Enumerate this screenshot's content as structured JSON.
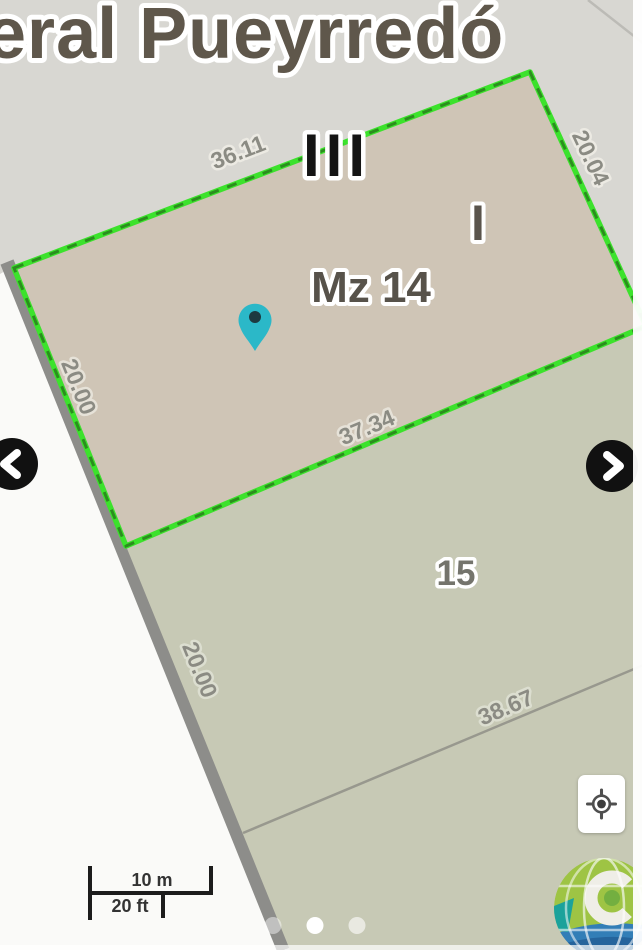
{
  "street": {
    "name": "eral Pueyrredó"
  },
  "parcel": {
    "block_label": "Mz 14",
    "edge_top": "36.11",
    "edge_right": "20.04",
    "edge_left": "20.00",
    "edge_bottom": "37.34"
  },
  "zones": {
    "roman_three": "III",
    "roman_one": "I"
  },
  "neighbor": {
    "number": "15",
    "edge_road": "20.00",
    "edge_lower": "38.67"
  },
  "scale_bar": {
    "metric": "10 m",
    "imperial": "20 ft"
  },
  "carousel": {
    "dot_count": 3,
    "active_dot": 2
  },
  "icons": {
    "prev": "chevron-left",
    "next": "chevron-right",
    "locate": "my-location-target",
    "marker": "map-pin",
    "watermark": "globe-logo"
  },
  "colors": {
    "boundary_green": "#3ce22c",
    "boundary_dash": "#2b8e1e",
    "parcel_fill": "#cfc5b6",
    "neighbor_fill": "#c7c9b5",
    "pavement": "#d8d7d2",
    "street_white": "#fafaf8",
    "road_edge_gray": "#8d8d8a",
    "pin_teal": "#2bb8c8",
    "label_gray": "#8b8b83",
    "street_text": "#5f574b"
  }
}
